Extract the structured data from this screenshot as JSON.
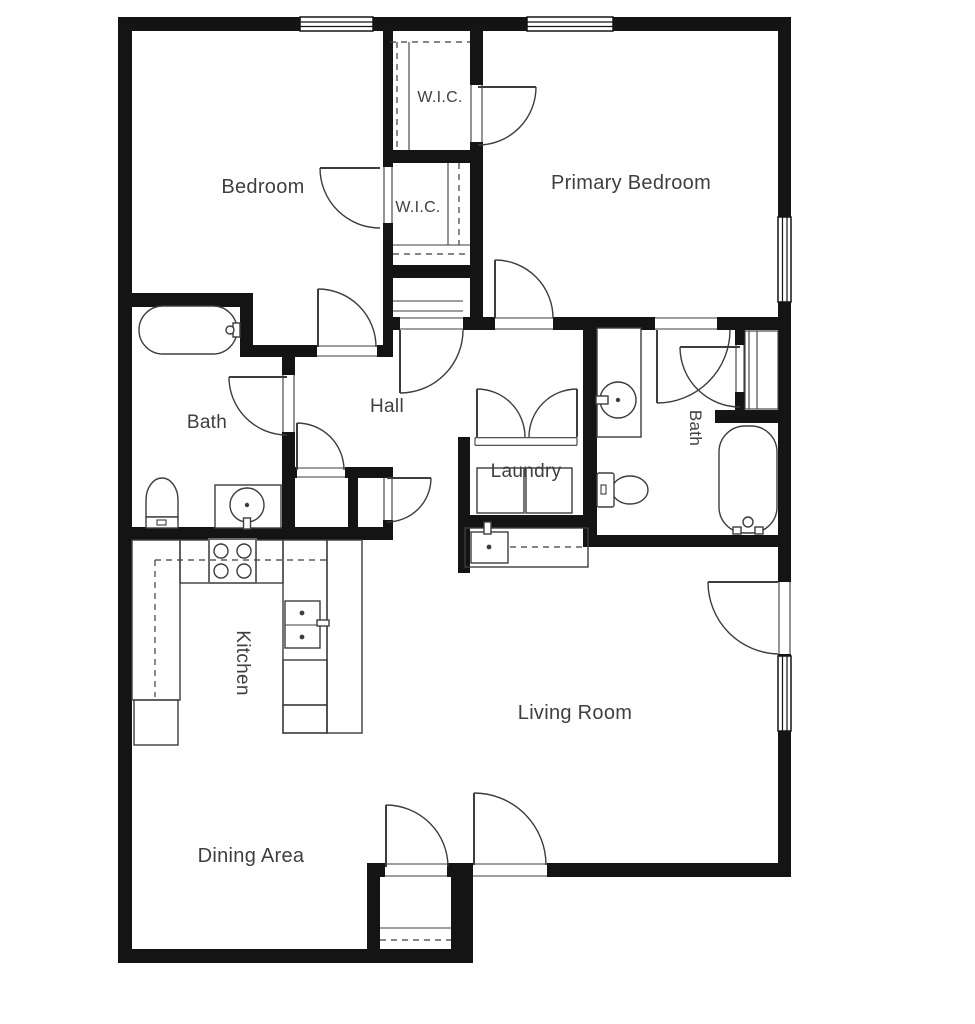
{
  "plan_type": "floor-plan",
  "colors": {
    "wall": "#141414",
    "line": "#3d3d3d",
    "text": "#3f3f3f",
    "background": "#ffffff"
  },
  "rooms": [
    {
      "name": "bedroom",
      "label": "Bedroom",
      "x": 263,
      "y": 193,
      "size": 20,
      "rotate": 0
    },
    {
      "name": "wic-1",
      "label": "W.I.C.",
      "x": 440,
      "y": 102,
      "size": 16,
      "rotate": 0
    },
    {
      "name": "wic-2",
      "label": "W.I.C.",
      "x": 418,
      "y": 212,
      "size": 16,
      "rotate": 0
    },
    {
      "name": "primary-bedroom",
      "label": "Primary Bedroom",
      "x": 631,
      "y": 189,
      "size": 20,
      "rotate": 0
    },
    {
      "name": "bath-1",
      "label": "Bath",
      "x": 207,
      "y": 428,
      "size": 19,
      "rotate": 0
    },
    {
      "name": "hall",
      "label": "Hall",
      "x": 387,
      "y": 412,
      "size": 19,
      "rotate": 0
    },
    {
      "name": "laundry",
      "label": "Laundry",
      "x": 526,
      "y": 477,
      "size": 19,
      "rotate": 0
    },
    {
      "name": "bath-2",
      "label": "Bath",
      "x": 690,
      "y": 428,
      "size": 17,
      "rotate": 90
    },
    {
      "name": "kitchen",
      "label": "Kitchen",
      "x": 237,
      "y": 663,
      "size": 19,
      "rotate": 90
    },
    {
      "name": "living-room",
      "label": "Living Room",
      "x": 575,
      "y": 719,
      "size": 20,
      "rotate": 0
    },
    {
      "name": "dining-area",
      "label": "Dining Area",
      "x": 251,
      "y": 862,
      "size": 20,
      "rotate": 0
    }
  ]
}
